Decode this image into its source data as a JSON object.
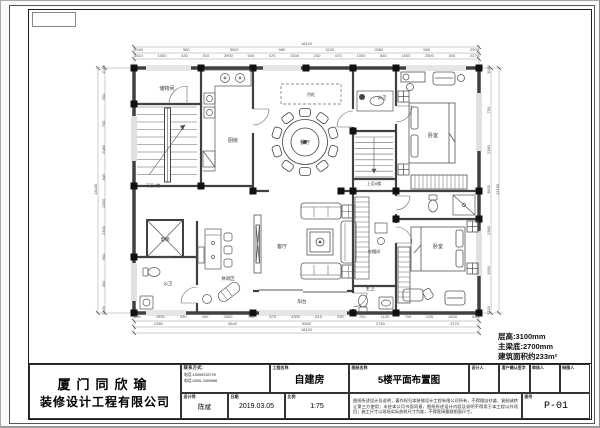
{
  "info_block": {
    "floor_height": "层高:3100mm",
    "beam_bottom": "主梁底:2700mm",
    "area": "建筑面积约233m²"
  },
  "title_block": {
    "company_line1": "厦门同欣瑜",
    "company_line2": "装修设计工程有限公司",
    "contact_label": "联系方式:",
    "phone1": "电话:15959233799",
    "phone2": "电话:0595-7689988",
    "designer_label": "设计师",
    "designer_value": "陈斌",
    "date_label": "日期",
    "date_value": "2019.03.05",
    "scale_label": "比例",
    "scale_value": "1:75",
    "project_label": "工程名称",
    "project_value": "自建房",
    "drawing_label": "图纸名称",
    "drawing_value": "5楼平面布置图",
    "sign_cells": [
      {
        "label": "设计人"
      },
      {
        "label": "客户确认签字"
      },
      {
        "label": "审核人"
      },
      {
        "label": "制图人"
      }
    ],
    "notes": "图纸所述设计及说明，著作权归本装修设计工程有限公司所有，不得擅自抄袭、复制或转让第三方使用；未经本公司书面同意，图纸所述设计内容及说明不得用于本工程以外项目；施工尺寸以现场实际放样尺寸为准，不得直接量取图面尺寸。",
    "sheet_no_label": "图号",
    "sheet_no": "P-01"
  },
  "plan": {
    "room_labels": {
      "storage": "储物间",
      "kitchen": "厨房",
      "dining": "餐厅",
      "hang_cabinet": "吊柜",
      "bath_top": "公卫",
      "bedroom_top": "卧室",
      "bedroom_bottom": "卧室",
      "closet": "衣帽间",
      "master_bath": "主卫",
      "living": "客厅",
      "balcony": "阳台",
      "leisure": "休闲区",
      "bath_left": "公卫",
      "elevator": "电梯",
      "stairs_down": "下至4楼",
      "stairs_up": "上至6楼"
    }
  },
  "dims": {
    "top_overall": "18100",
    "top_mid": [
      "2940",
      "980",
      "3920",
      "980",
      "3220",
      "2580",
      "980",
      "2500"
    ],
    "top_detail": [
      "1510",
      "1000",
      "430",
      "510",
      "2900",
      "540",
      "470",
      "1500",
      "240",
      "670",
      "1000",
      "560",
      "1500",
      "2500",
      "500",
      "2270"
    ],
    "bottom_detail": [
      "430",
      "1500",
      "430",
      "400",
      "2500",
      "740",
      "670",
      "4300",
      "610",
      "930",
      "700",
      "1120",
      "700",
      "635",
      "1800",
      "635"
    ],
    "bottom_mid": [
      "2360",
      "3640",
      "5580",
      "2750",
      "3770"
    ],
    "bottom_overall": "18100",
    "left_detail": [
      "1130",
      "300",
      "700",
      "2080",
      "845",
      "2380",
      "2300",
      "600",
      "450",
      "2395"
    ],
    "left_overall": "13180",
    "right_detail": [
      "1080",
      "700",
      "2380",
      "3800",
      "2380",
      "1590",
      "1250"
    ],
    "right_overall": "13180"
  }
}
